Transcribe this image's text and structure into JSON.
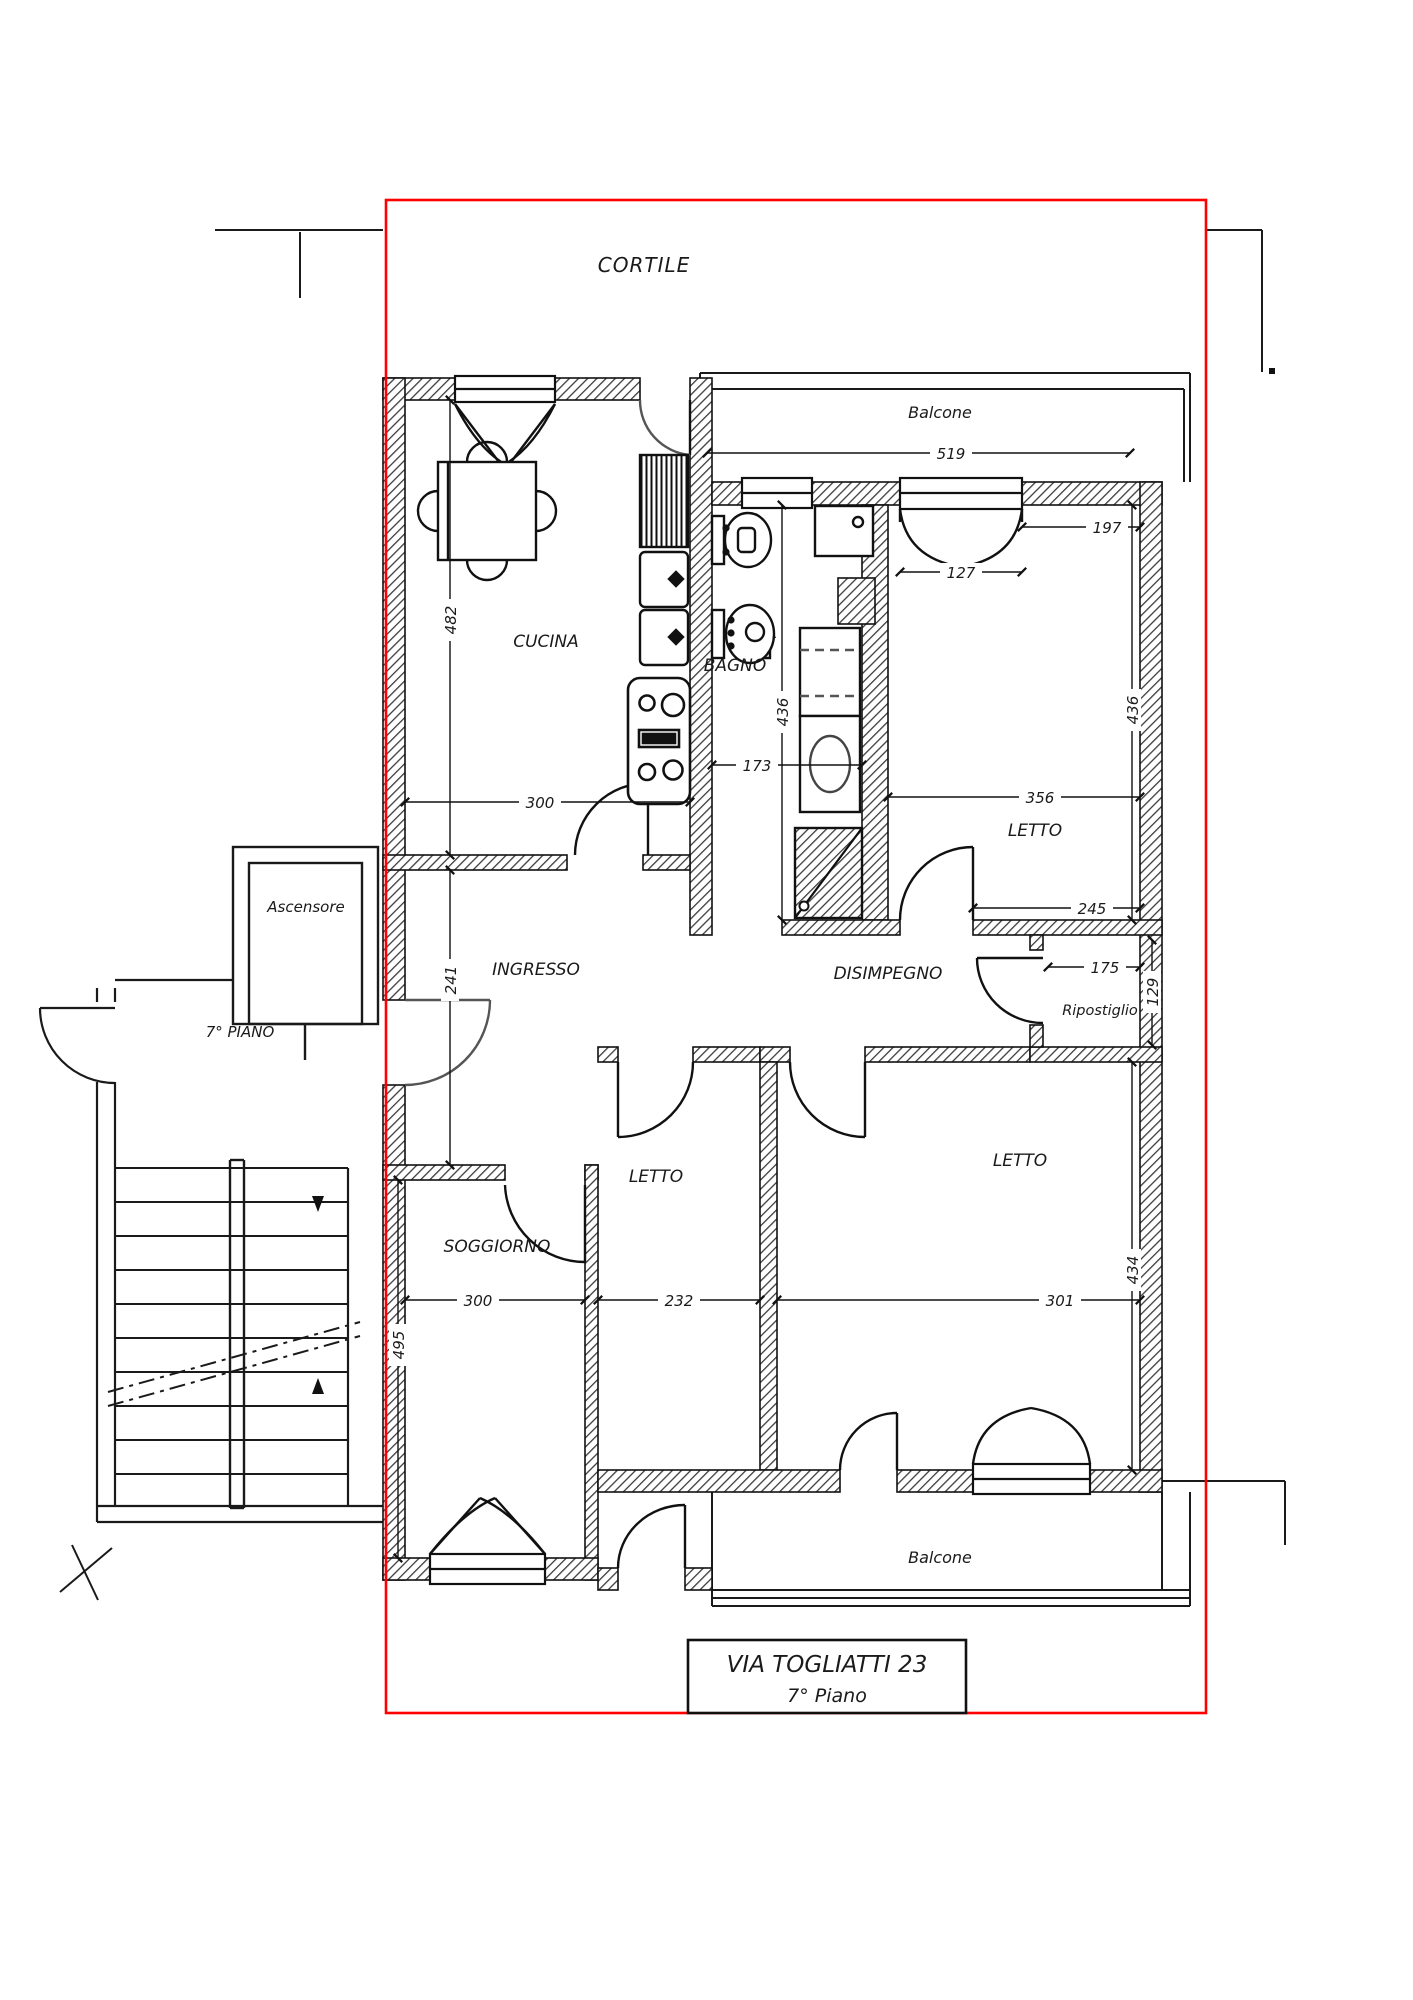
{
  "site": {
    "cortile_label": "CORTILE"
  },
  "balcony_top": {
    "label": "Balcone",
    "width_dim": "519"
  },
  "kitchen": {
    "label": "CUCINA",
    "height_dim": "482",
    "width_dim": "300"
  },
  "bathroom": {
    "label": "BAGNO",
    "height_dim": "436",
    "width_dim": "173"
  },
  "bedroom_top": {
    "label": "LETTO",
    "width_dim": "356",
    "height_dim": "436",
    "window_dim": "127",
    "wall_dim": "197",
    "door_wall_dim": "245"
  },
  "entry_hall": {
    "label": "INGRESSO",
    "height_dim": "241"
  },
  "corridor": {
    "label": "DISIMPEGNO"
  },
  "storage": {
    "label": "Ripostiglio",
    "width_dim": "175",
    "height_dim": "129"
  },
  "living_room": {
    "label": "SOGGIORNO",
    "width_dim": "300",
    "height_dim": "495"
  },
  "bedroom_mid": {
    "label": "LETTO",
    "width_dim": "232"
  },
  "bedroom_right": {
    "label": "LETTO",
    "width_dim": "301",
    "height_dim": "434"
  },
  "balcony_bottom": {
    "label": "Balcone"
  },
  "stairwell": {
    "elevator_label": "Ascensore",
    "landing_label": "7° PIANO"
  },
  "title_box": {
    "address": "VIA TOGLIATTI 23",
    "floor": "7° Piano"
  },
  "colors": {
    "boundary_red": "#ff0000",
    "ink": "#1a1a1a"
  }
}
